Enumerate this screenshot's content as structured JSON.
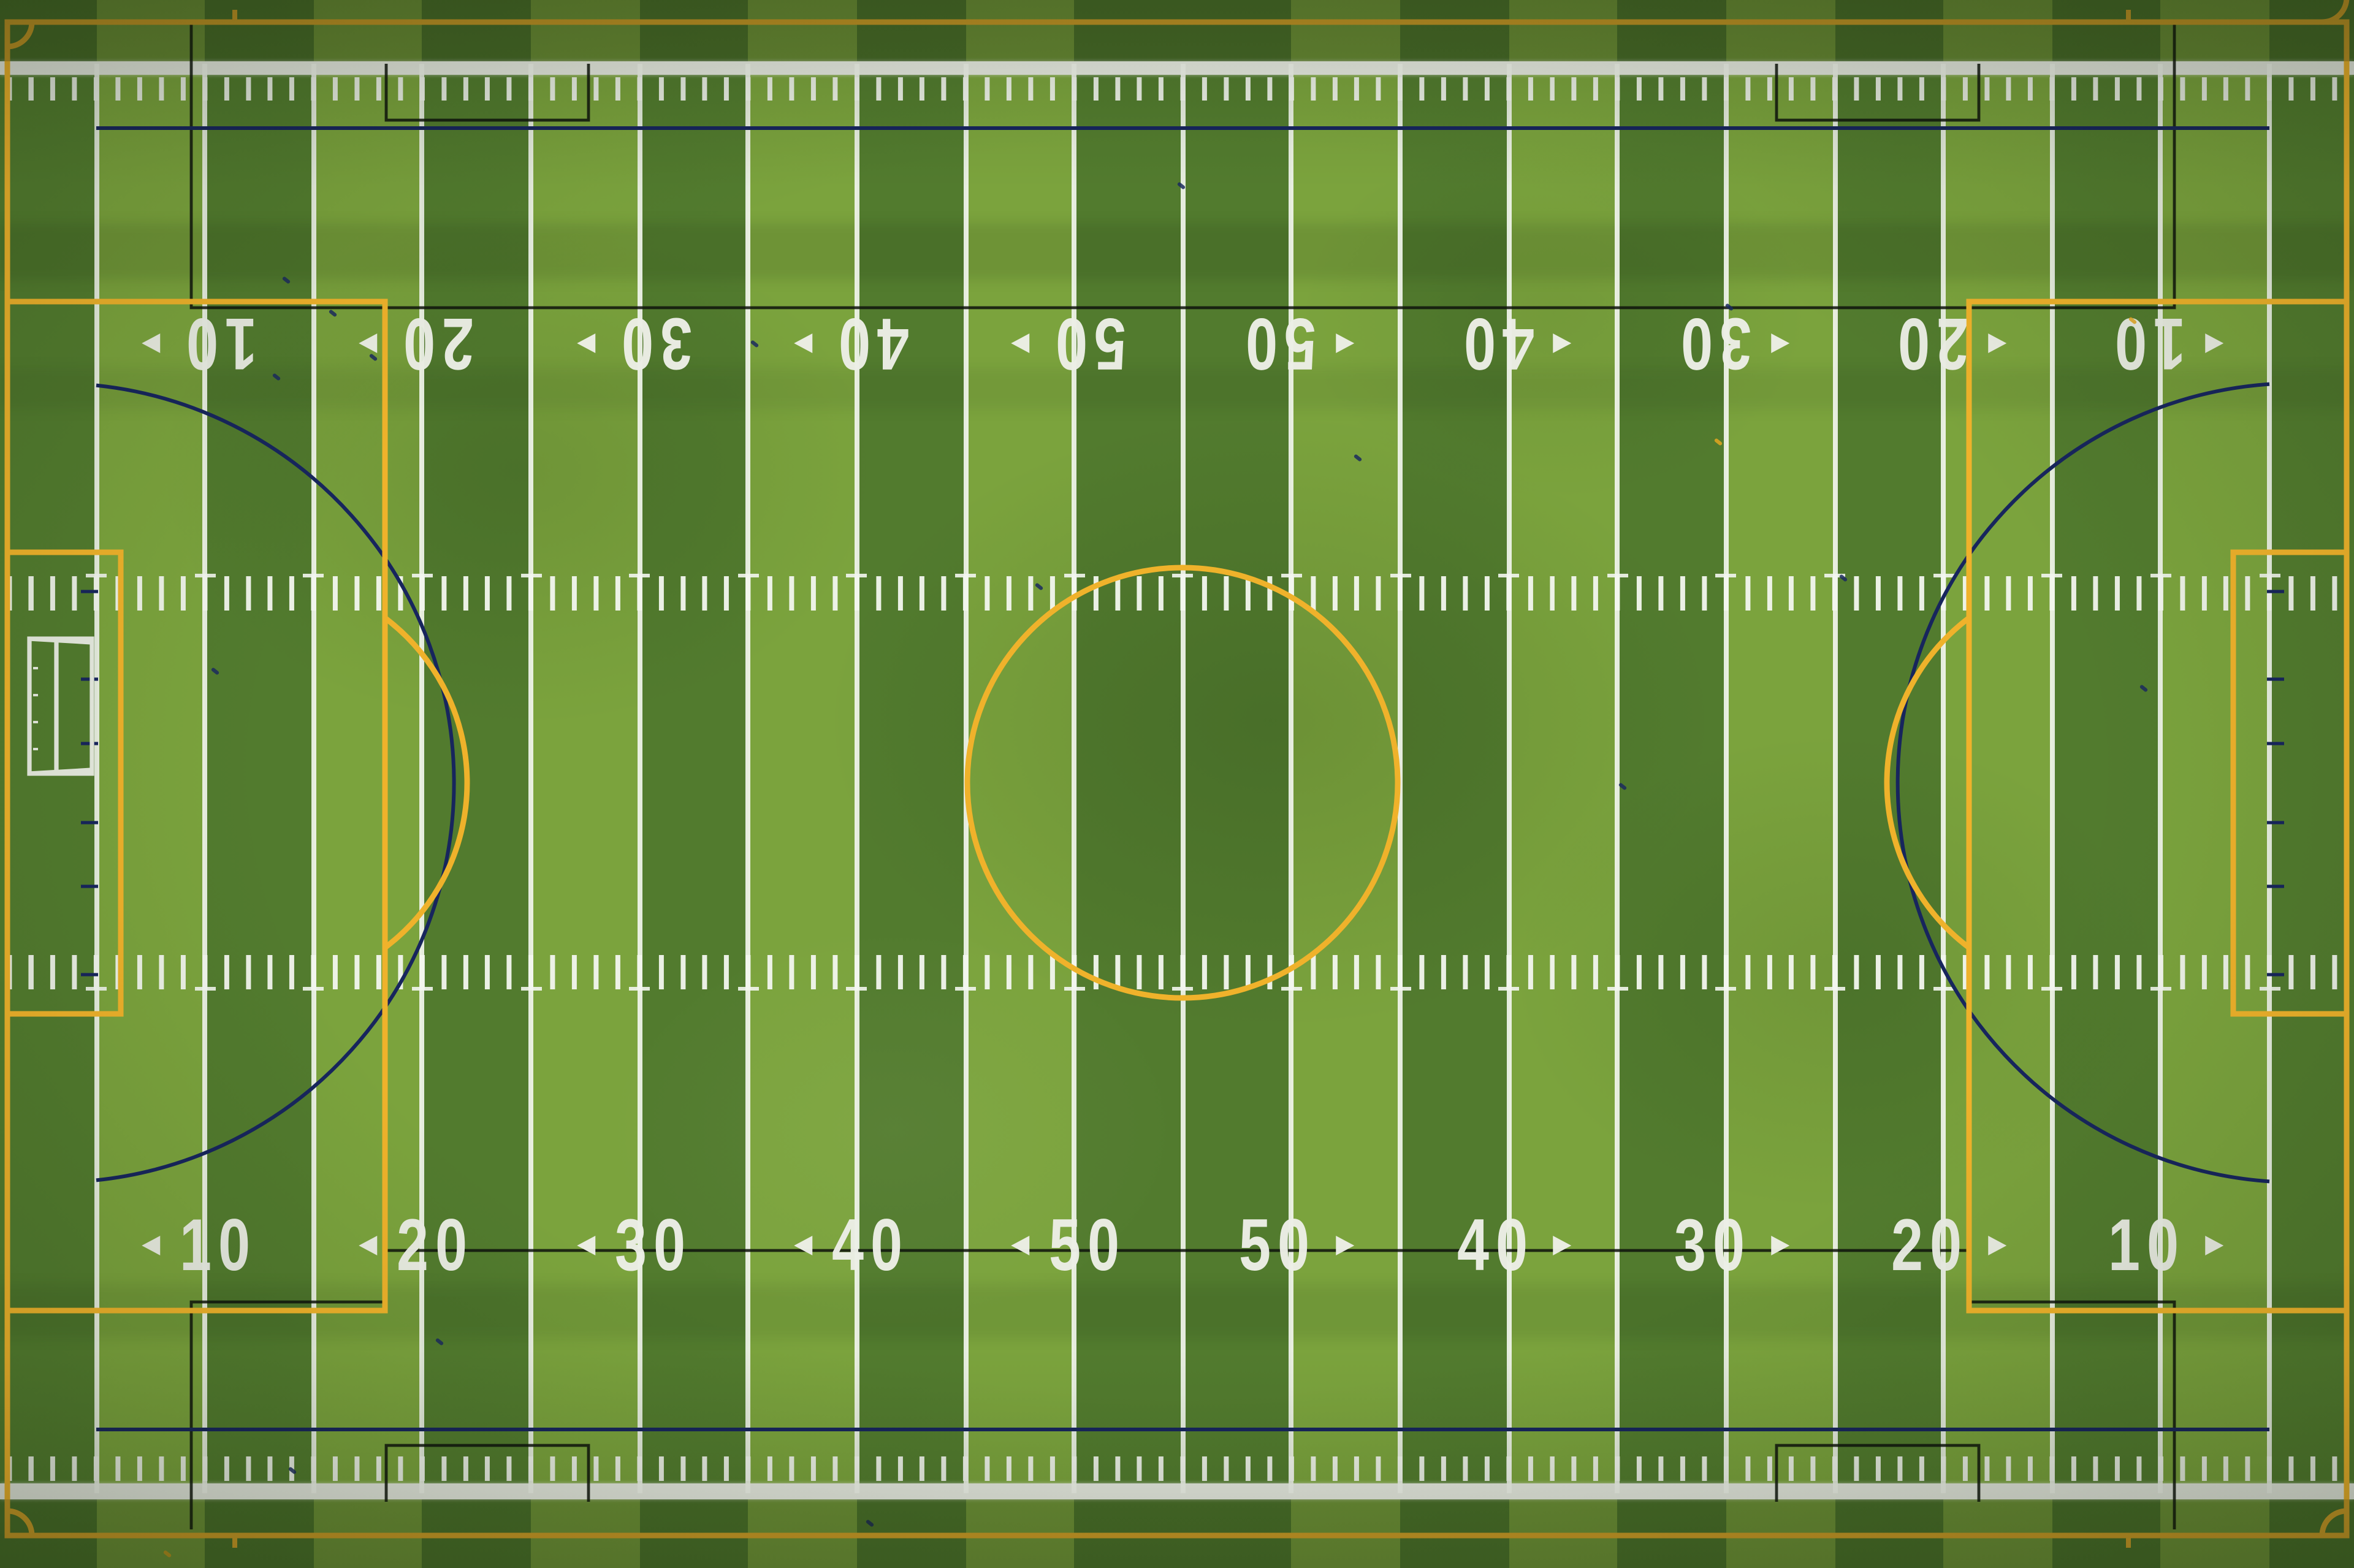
{
  "meta": {
    "description": "Overhead aerial drone photograph of a green artificial-turf multi-sport field with white football yard lines, yellow soccer markings, navy and black overlay lines, and a white portable goal frame on the left side",
    "view": "top-down"
  },
  "field": {
    "yard_numbers": [
      {
        "row": "top",
        "label": "10",
        "line_index": 1,
        "arrow": "left"
      },
      {
        "row": "top",
        "label": "20",
        "line_index": 3,
        "arrow": "left"
      },
      {
        "row": "top",
        "label": "30",
        "line_index": 5,
        "arrow": "left"
      },
      {
        "row": "top",
        "label": "40",
        "line_index": 7,
        "arrow": "left"
      },
      {
        "row": "top",
        "label": "50",
        "line_index": 9,
        "arrow": "left"
      },
      {
        "row": "top",
        "label": "50",
        "line_index": 11,
        "arrow": "right"
      },
      {
        "row": "top",
        "label": "40",
        "line_index": 13,
        "arrow": "right"
      },
      {
        "row": "top",
        "label": "30",
        "line_index": 15,
        "arrow": "right"
      },
      {
        "row": "top",
        "label": "20",
        "line_index": 17,
        "arrow": "right"
      },
      {
        "row": "top",
        "label": "10",
        "line_index": 19,
        "arrow": "right"
      },
      {
        "row": "bottom",
        "label": "10",
        "line_index": 1,
        "arrow": "left"
      },
      {
        "row": "bottom",
        "label": "20",
        "line_index": 3,
        "arrow": "left"
      },
      {
        "row": "bottom",
        "label": "30",
        "line_index": 5,
        "arrow": "left"
      },
      {
        "row": "bottom",
        "label": "40",
        "line_index": 7,
        "arrow": "left"
      },
      {
        "row": "bottom",
        "label": "50",
        "line_index": 9,
        "arrow": "left"
      },
      {
        "row": "bottom",
        "label": "50",
        "line_index": 11,
        "arrow": "right"
      },
      {
        "row": "bottom",
        "label": "40",
        "line_index": 13,
        "arrow": "right"
      },
      {
        "row": "bottom",
        "label": "30",
        "line_index": 15,
        "arrow": "right"
      },
      {
        "row": "bottom",
        "label": "20",
        "line_index": 17,
        "arrow": "right"
      },
      {
        "row": "bottom",
        "label": "10",
        "line_index": 19,
        "arrow": "right"
      }
    ],
    "top_row_inverted": true,
    "yard_line_count": 21,
    "hash_mark_rows": 2,
    "sideline_tick_rows": 2,
    "overlays": {
      "football": {
        "color": "#edefe7",
        "elements": [
          "sidelines",
          "yard-lines",
          "hash-marks",
          "yard-numbers",
          "directional-arrows"
        ]
      },
      "soccer": {
        "color": "#efb22b",
        "elements": [
          "touchline-top",
          "touchline-bottom",
          "goal-line-left",
          "goal-line-right",
          "center-circle",
          "penalty-box-left",
          "penalty-box-right",
          "goal-area-left",
          "goal-area-right",
          "penalty-arc-left",
          "penalty-arc-right",
          "corner-arcs",
          "corner-ticks"
        ]
      },
      "navy": {
        "color": "#17255d",
        "elements": [
          "restraining-line-top",
          "restraining-line-bottom",
          "large-arc-left",
          "large-arc-right",
          "line-ticks",
          "turf-specks"
        ]
      },
      "black": {
        "color": "#0e130c",
        "elements": [
          "drop-rectangle-top",
          "drop-rectangle-bottom",
          "corner-notches"
        ]
      }
    },
    "equipment": {
      "left_goal": "white portable soccer goal frame lying near left goal line",
      "right_goal": "none"
    },
    "colors": {
      "turf_light": "#7ba33d",
      "turf_dark": "#527b2e",
      "out_of_bounds": "#567c30",
      "line_white": "#edefe7",
      "soccer_yellow": "#efb22b",
      "overlay_navy": "#17255d",
      "overlay_black": "#0e130c"
    }
  }
}
